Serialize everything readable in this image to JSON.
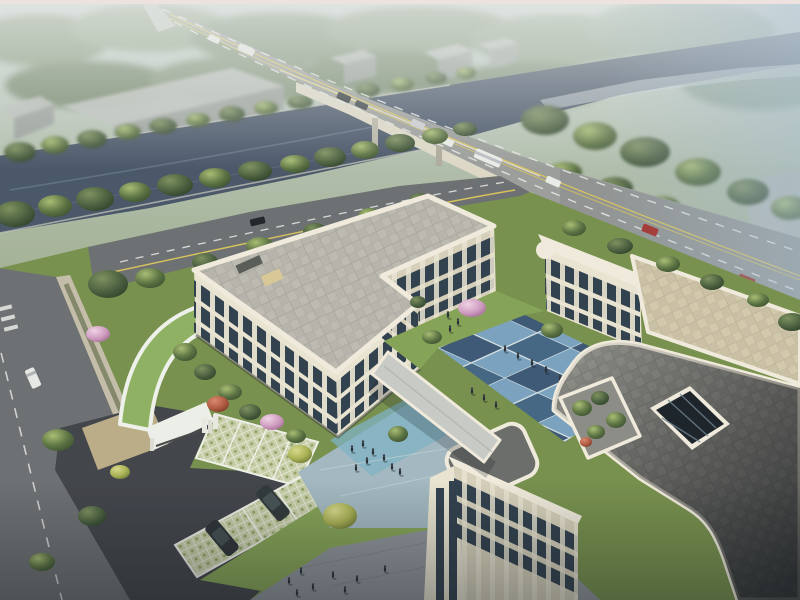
{
  "scene": {
    "type": "architectural aerial rendering",
    "description": "Bird's-eye render of a cream three-storey school/office complex with blue checkerboard courtyard, roof terrace, grass-paver parking, curved green-roof gatehouse, riverside arterial road with bridge and misty forest background",
    "frame_border_color": "#eee2de"
  },
  "palette": {
    "sky_haze": "#ccd6d8",
    "mist_blue": "#a9bfd0",
    "forest": "#7a8b72",
    "river": "#4b586a",
    "road": "#9b9e9b",
    "street": "#6e7174",
    "asphalt": "#43464b",
    "lane_white": "#e8eae6",
    "lane_yellow": "#d8c35c",
    "building_cream": "#e9e4d1",
    "building_shadow": "#d6d0ba",
    "fascia": "#efeadb",
    "roof_gray_light": "#b6b4ab",
    "roof_paver": "#8f8f8a",
    "roof_warm": "#cac0a5",
    "roof_dark": "#3c4044",
    "window_dark": "#33424f",
    "window_light": "#8fa6b4",
    "court_blue_dark": "#3f5a77",
    "court_blue_light": "#7ba3bf",
    "plaza_light": "#a3b8c0",
    "plaza_teal": "#7fb3c4",
    "plaza_gray": "#8f949a",
    "lawn": "#78914e",
    "lawn_bright": "#86a457",
    "green_roof": "#8fb164",
    "grass_paver": "#c6cda6",
    "blossom_pink": "#d9a9c9",
    "maple_red": "#b05a42",
    "tree_green": "#5c7344",
    "tree_yellow": "#a8b054",
    "suv_dark": "#2f3538",
    "car_red": "#a32c26",
    "car_white": "#e9ebe7",
    "people_dark": "#2c3137"
  },
  "inventory": {
    "vehicles_main_road": [
      "white bus",
      "white car",
      "silver car",
      "dark car",
      "dark car",
      "red car",
      "red car",
      "distant white bus",
      "distant white car"
    ],
    "vehicles_local_street": [
      "dark car"
    ],
    "vehicles_side_street": [
      "white van"
    ],
    "vehicles_parked": [
      "dark suv",
      "dark suv"
    ],
    "pedestrian_groups": {
      "courtyard": 12,
      "entrance_plaza": 8,
      "south_plaza": 8,
      "courtyard_lawn": 3
    },
    "landscape": [
      "river",
      "bridge",
      "elevated ramp",
      "misty forest",
      "warehouse blocks",
      "riverside tree rows",
      "cherry blossom trees",
      "red maple",
      "green-roof gatehouse",
      "grass-paver parking",
      "roof terrace garden",
      "atrium skylight"
    ]
  }
}
